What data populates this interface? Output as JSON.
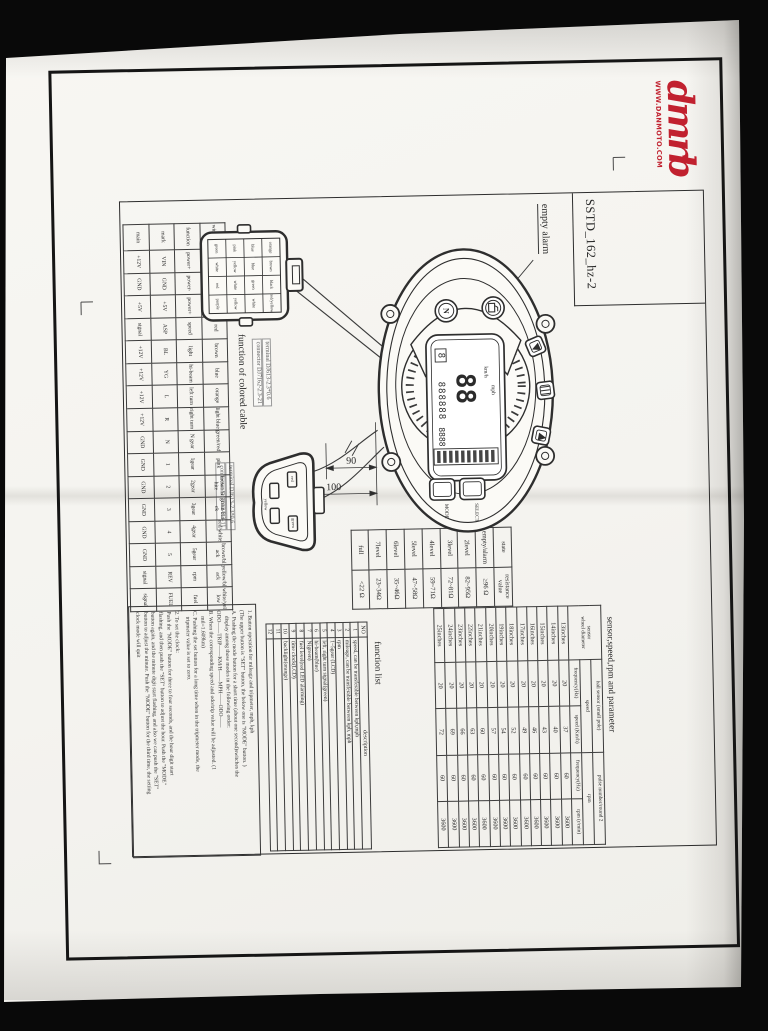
{
  "scan": {
    "logo_text": "dmrb",
    "logo_site": "WWW.DANMOTO.COM",
    "logo_color": "#c1212f",
    "doc_code": "SSTD_162_hz-2",
    "empty_alarm_label": "empty alarm",
    "cable_label": "function of colored cable",
    "dims": {
      "d1": "90",
      "d2": "100"
    }
  },
  "gauge": {
    "btn_mode": "MODE",
    "btn_select": "SELECT",
    "lcd_big": "88",
    "lcd_odo": "888888",
    "lcd_small": "8888",
    "gear_digit": "8",
    "kmh": "km/h",
    "mph": "mph",
    "lamp_n": "N"
  },
  "connectors": {
    "c1_note_line1": "terminal DJ613-2.3*0.6",
    "c1_note_line2": "connector DJ7162-2.3-21",
    "c2_note_line1": "terminal DJ613-2.3*0.6",
    "c2_note_line2": "connector DJ7032-2.3-11",
    "c1_grid": [
      [
        "green",
        "pink",
        "blue",
        "orange"
      ],
      [
        "white",
        "yellow",
        "blue",
        "brown"
      ],
      [
        "red",
        "white",
        "green",
        "black"
      ],
      [
        "purple",
        "yellow",
        "white",
        "red/yellow"
      ]
    ],
    "c2_pins": [
      "yellow",
      "red",
      "green"
    ]
  },
  "wiring_table": {
    "rows": [
      [
        "wire color",
        "black",
        "green",
        "yellow",
        "red",
        "brown",
        "blue",
        "orange",
        "light blue",
        "green/red",
        "pink",
        "brown/white",
        "green/black",
        "red/white",
        "brown/black",
        "yellow/black",
        "white/yellow"
      ],
      [
        "function",
        "power+",
        "power-",
        "power+",
        "speed",
        "light",
        "hi-beam",
        "left turn",
        "right turn",
        "N gear",
        "1gear",
        "2gear",
        "3gear",
        "4gear",
        "5gear",
        "rpm",
        "fuel"
      ],
      [
        "mark",
        "VIN",
        "GND",
        "+5V",
        "ASP",
        "BL",
        "YG",
        "L",
        "R",
        "N",
        "1",
        "2",
        "3",
        "4",
        "5",
        "REV",
        "FUEL"
      ],
      [
        "main",
        "+12V",
        "GND",
        "+5V",
        "signal",
        "+12V",
        "+12V",
        "+12V",
        "+12V",
        "GND",
        "GND",
        "GND",
        "GND",
        "GND",
        "GND",
        "signal",
        "signal"
      ]
    ]
  },
  "resistance_table": {
    "headers": [
      "state",
      "resistance value"
    ],
    "rows": [
      [
        "empty/alarm",
        "≥96 Ω"
      ],
      [
        "2level",
        "82~95Ω"
      ],
      [
        "3level",
        "72~81Ω"
      ],
      [
        "4level",
        "59~71Ω"
      ],
      [
        "5level",
        "47~58Ω"
      ],
      [
        "6level",
        "35~46Ω"
      ],
      [
        "7level",
        "23~34Ω"
      ],
      [
        "full",
        "<22 Ω"
      ]
    ]
  },
  "sensor_table": {
    "title": "sensor,speed,rpm and parameter",
    "h_sensor": "sensor",
    "h_wheel": "wheel diameter",
    "h_hall": "hall sensor (small pole)",
    "h_pulse": "pulse number/round 2",
    "h_speed": "speed",
    "h_rpm": "rpm",
    "h_freq1": "frequency(Hz)",
    "h_kmh": "speed (Km/h)",
    "h_freq2": "frequency(Hz)",
    "h_rmin": "rpm (r/min)",
    "rows": [
      [
        "13inches",
        "20",
        "37",
        "60",
        "3600"
      ],
      [
        "14inches",
        "20",
        "40",
        "60",
        "3600"
      ],
      [
        "15inches",
        "20",
        "43",
        "60",
        "3600"
      ],
      [
        "16inches",
        "20",
        "46",
        "60",
        "3600"
      ],
      [
        "17inches",
        "20",
        "49",
        "60",
        "3600"
      ],
      [
        "18inches",
        "20",
        "52",
        "60",
        "3600"
      ],
      [
        "19inches",
        "20",
        "54",
        "60",
        "3600"
      ],
      [
        "20inches",
        "20",
        "57",
        "60",
        "3600"
      ],
      [
        "21inches",
        "20",
        "60",
        "60",
        "3600"
      ],
      [
        "22inches",
        "20",
        "63",
        "60",
        "3600"
      ],
      [
        "23inches",
        "20",
        "66",
        "60",
        "3600"
      ],
      [
        "24inches",
        "20",
        "69",
        "60",
        "3600"
      ],
      [
        "25inches",
        "20",
        "72",
        "60",
        "3600"
      ]
    ]
  },
  "function_list": {
    "title": "function list",
    "h_no": "NO",
    "h_desc": "description",
    "rows": [
      [
        "1",
        "speed, can be transferable between kph,mph"
      ],
      [
        "2",
        "mileage, can be transferable between kph, mph"
      ],
      [
        "3",
        "rpm"
      ],
      [
        "4",
        "1~5gear (LCD)"
      ],
      [
        "5",
        "left, right turn signal(green)"
      ],
      [
        "6",
        "hi-beam(blue)"
      ],
      [
        "7",
        "N(green)"
      ],
      [
        "8",
        "fuel level(red LED alarming)"
      ],
      [
        "9",
        "time clock(LCD)"
      ],
      [
        "10",
        "backlight(orange)"
      ],
      [
        "11",
        ""
      ],
      [
        "12",
        ""
      ]
    ]
  },
  "notes": {
    "lines1": [
      "1. Button operation for mileage and tripmeter, mph, kph",
      "(The upper button is \"SET\" button, the below one is \"MODE\" button. )",
      "A. Pushing the mode button for a short time (about one second)switches the",
      "    display among those modes in the following order:",
      "ODO——TRIP——KM/H——MPH——ODO——",
      "B. When the corresponding speed and odo/trip value will be adjusted. (1",
      "    mil=1.609km)",
      "C. Pushing the set button for a long time when in the tripmeter mode, the",
      "    tripmeter value is set to zero."
    ],
    "lines2": [
      "2. To set the clock:",
      "Push the \"MODE\" button for three to four seconds, and the hour digit start",
      "flashing, and then push the \"SET\" button to adjust the hour. Push the \"MODE\"",
      "button again, and the minute digit start flashing, and also we can push the \"SET\"",
      "button to adjust the minute. Push the \"MODE\" button for the third time, the setting",
      "clock mode will quit"
    ]
  }
}
